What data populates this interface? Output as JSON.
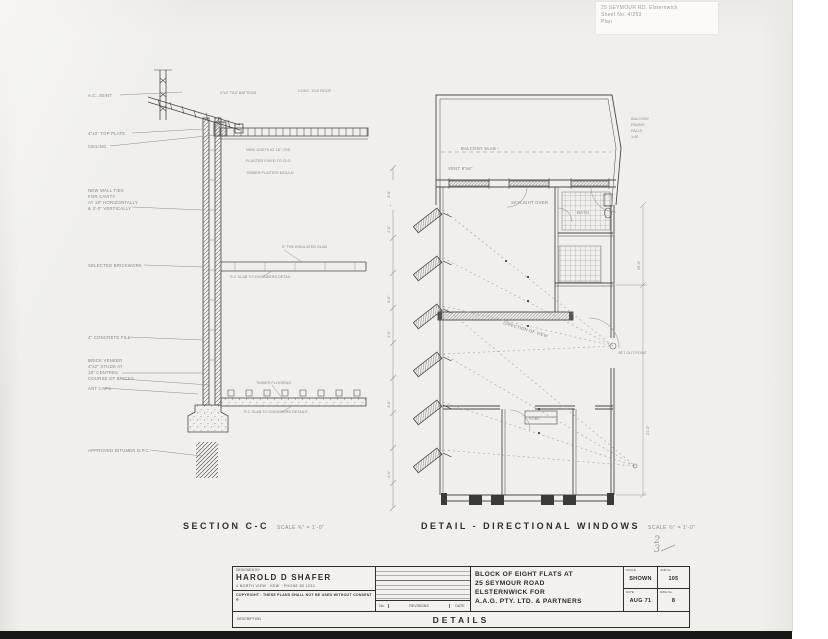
{
  "stamp": {
    "line1": "25 SEYMOUR RD. Elsternwick",
    "line2": "Sheet No. 4/253",
    "line3": "Plan"
  },
  "section": {
    "title": "SECTION C-C",
    "scale": "SCALE ¾\" = 1'-0\"",
    "ann": {
      "ac_joint": "A.C. JOINT",
      "top_plate": "4\"x3\" TOP PLATE",
      "ceiling": "CEILING",
      "ties1": "NEW WALL TIES",
      "ties2": "FOR CAVITY",
      "ties3": "AT 18\" HORIZONTALLY",
      "ties4": "& 3'-0\" VERTICALLY",
      "brickwork": "SELECTED BRICKWORK",
      "fill": "4\" CONCRETE FILL",
      "veneer1": "BRICK VENEER",
      "veneer2": "4\"x2\" STUDS AT",
      "veneer3": "18\" CENTRES",
      "veneer4": "COURSE OF BRICKS",
      "ant": "ANT CAPS",
      "dpc": "APPROVED BITUMEN D.P.C.",
      "battens": "3\"x2\" TILE BATTENS",
      "roof": "CONC. TILE ROOF",
      "joists": "NEW JOISTS AT 18\" CRS",
      "plaster": "PLASTER FIXED TO CLG",
      "mould": "TIMBER PLASTER MOULD",
      "slab5": "5\" THK INSULATED SLAB",
      "rcslab1": "R.C SLAB TO ENGINEERS DETAIL",
      "flooring": "TIMBER FLOORING",
      "rcslab2": "R.C SLAB TO ENGINEERS DETAILS"
    }
  },
  "plan": {
    "title": "DETAIL - DIRECTIONAL WINDOWS",
    "scale": "SCALE ½\" = 1'-0\"",
    "ann": {
      "balcony": "BALCONY SLAB ↑",
      "vent": "VENT 9\"x6\"",
      "note1": "BALCONY",
      "note2": "PAVING",
      "note3": "FALLS",
      "note4": "1:40",
      "skylight": "SKYLIGHT OVER",
      "direction": "DIRECTION OF VIEW",
      "setout": "SET OUT POINT",
      "bath": "BATH",
      "robe": "ROBE",
      "dim_right1": "29'-6\"",
      "dim_right2": "21'-0\"",
      "d1": "3'-6\"",
      "d2": "4'-0\"",
      "d3": "3'-6\"",
      "d4": "4'-0\"",
      "d5": "3'-6\"",
      "d6": "4'-0\""
    }
  },
  "fraction": {
    "top": "2",
    "bottom": "3"
  },
  "titleblock": {
    "designed_by": "DESIGNED BY",
    "architect": "HAROLD D SHAFER",
    "address": "4 NORTH VIEW · KEW · PHONE 80 1234",
    "copyright": "COPYRIGHT · THESE PLANS SHALL NOT BE USED WITHOUT CONSENT ®",
    "no_label": "No.",
    "revisions_label": "REVISIONS",
    "date_label": "DATE",
    "project_line1": "BLOCK OF EIGHT FLATS AT",
    "project_line2": "25 SEYMOUR ROAD",
    "project_line3": "ELSTERNWICK  FOR",
    "project_line4": "A.A.G.  PTY. LTD. & PARTNERS",
    "scale_label": "SCALE",
    "scale_value": "SHOWN",
    "job_label": "JOB No.",
    "job_value": "105",
    "date_label2": "DATE",
    "date_value": "AUG 71",
    "dwg_label": "DWG No.",
    "dwg_value": "8",
    "description_label": "DESCRIPTION",
    "description_value": "DETAILS"
  }
}
